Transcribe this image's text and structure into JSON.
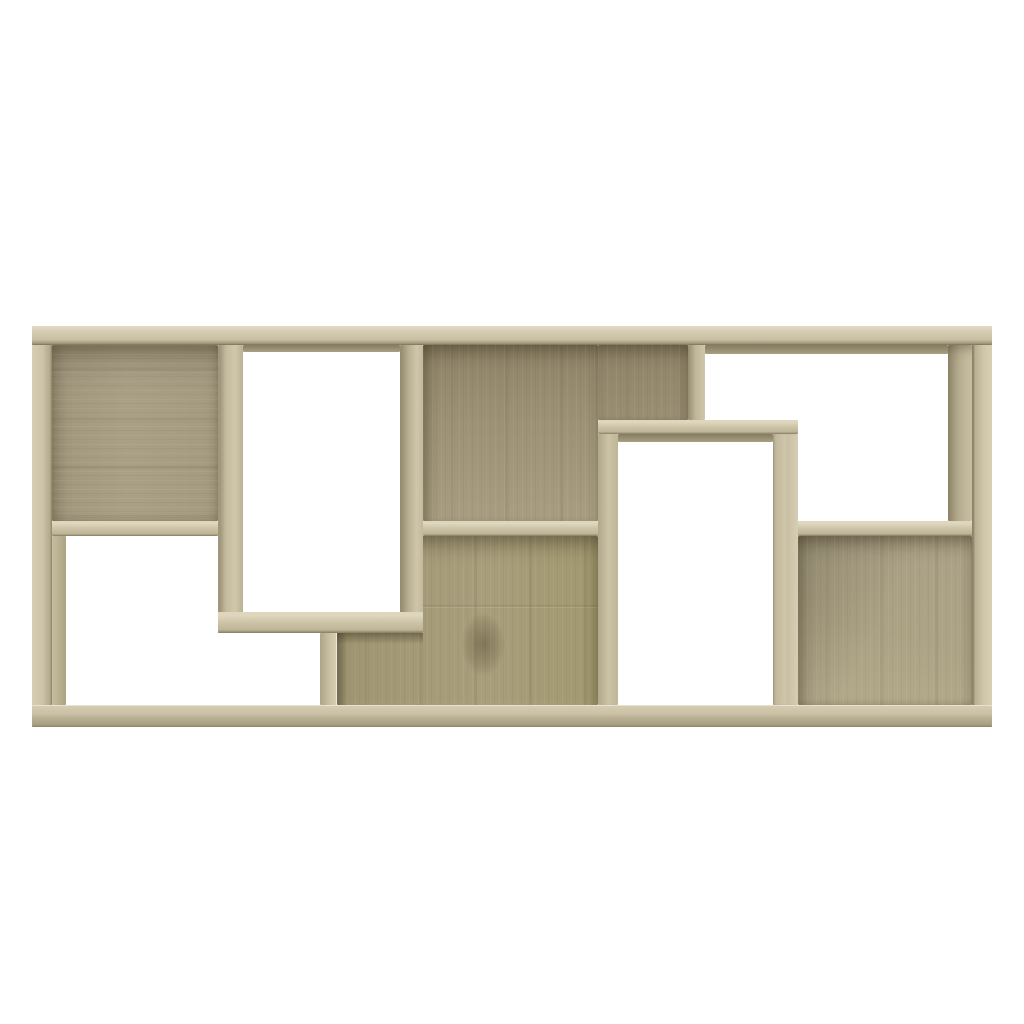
{
  "scene": {
    "background": "#ffffff",
    "object": "geometric-cube-bookcase",
    "finish": "sonoma-oak",
    "compartments_open": 4,
    "compartments_backed": 5,
    "unit_rect": {
      "x": 32,
      "y": 326,
      "w": 960,
      "h": 401
    }
  },
  "palette": {
    "bg": "#ffffff",
    "front_light": "#ddd5bc",
    "front": "#cdc4a8",
    "front_dark": "#a89e82",
    "seam": "#7b725a",
    "back": "#a89e83",
    "back_dark": "#8d8266",
    "back_light": "#b3a98d"
  },
  "parts": [
    {
      "id": "back-panel-top-left",
      "cls": "p-back-tl",
      "grain": "h",
      "x": 20,
      "y": 19,
      "w": 166,
      "h": 176
    },
    {
      "id": "back-panel-center-upper",
      "cls": "p-back-cu",
      "grain": "v",
      "x": 391,
      "y": 19,
      "w": 175,
      "h": 176
    },
    {
      "id": "back-panel-above-box2",
      "cls": "p-back-ab2",
      "grain": "v",
      "x": 566,
      "y": 19,
      "w": 90,
      "h": 75
    },
    {
      "id": "back-panel-center-lower",
      "cls": "p-back-cl",
      "grain": "v",
      "x": 305,
      "y": 210,
      "w": 261,
      "h": 169,
      "clip": "polygon(32.95% 0, 100% 0, 100% 100%, 0 100%, 0 57.4%, 32.95% 57.4%)"
    },
    {
      "id": "shade-under-box1-bottom",
      "cls": "p-shade-b",
      "x": 305,
      "y": 307,
      "w": 86,
      "h": 11
    },
    {
      "id": "shade-right-of-divider",
      "cls": "p-shade-r",
      "x": 305,
      "y": 307,
      "w": 11,
      "h": 72
    },
    {
      "id": "back-panel-bottom-right",
      "cls": "p-back-br",
      "grain": "v",
      "x": 766,
      "y": 210,
      "w": 174,
      "h": 169
    },
    {
      "id": "right-panel-inner-face",
      "cls": "p-strip-rp",
      "x": 916,
      "y": 19,
      "w": 24,
      "h": 176
    },
    {
      "id": "top-panel-underside-right",
      "cls": "p-strip-tu",
      "x": 673,
      "y": 19,
      "w": 243,
      "h": 9
    },
    {
      "id": "top-panel-underside-box1",
      "cls": "p-strip-tu",
      "x": 211,
      "y": 19,
      "w": 157,
      "h": 7
    },
    {
      "id": "box2-top-underside",
      "cls": "p-strip-tu",
      "x": 586,
      "y": 108,
      "w": 155,
      "h": 8
    },
    {
      "id": "left-panel-inner-face",
      "cls": "p-strip-lp",
      "x": 20,
      "y": 210,
      "w": 14,
      "h": 169
    },
    {
      "id": "mid-shelf-left",
      "cls": "p-shelf",
      "x": 20,
      "y": 195,
      "w": 166,
      "h": 15
    },
    {
      "id": "mid-shelf-center",
      "cls": "p-shelf",
      "x": 391,
      "y": 195,
      "w": 175,
      "h": 15
    },
    {
      "id": "mid-shelf-right",
      "cls": "p-shelf",
      "x": 766,
      "y": 195,
      "w": 174,
      "h": 15
    },
    {
      "id": "divider-top-right",
      "cls": "p-divt",
      "x": 656,
      "y": 19,
      "w": 17,
      "h": 75
    },
    {
      "id": "divider-bottom-left",
      "cls": "p-divb",
      "x": 288,
      "y": 307,
      "w": 17,
      "h": 72
    },
    {
      "id": "box1-left-wall",
      "cls": "p-b1l",
      "x": 186,
      "y": 19,
      "w": 25,
      "h": 288
    },
    {
      "id": "box1-right-wall",
      "cls": "p-b1r",
      "x": 368,
      "y": 19,
      "w": 23,
      "h": 288
    },
    {
      "id": "box1-bottom-panel",
      "cls": "p-shelf",
      "x": 186,
      "y": 286,
      "w": 205,
      "h": 21
    },
    {
      "id": "box2-top-panel",
      "cls": "p-shelf",
      "x": 566,
      "y": 94,
      "w": 200,
      "h": 14
    },
    {
      "id": "box2-left-wall",
      "cls": "p-b2l",
      "x": 566,
      "y": 108,
      "w": 20,
      "h": 271
    },
    {
      "id": "box2-right-wall",
      "cls": "p-b2r",
      "x": 741,
      "y": 108,
      "w": 25,
      "h": 271
    },
    {
      "id": "left-side-panel",
      "cls": "p-left",
      "x": 0,
      "y": 0,
      "w": 20,
      "h": 401
    },
    {
      "id": "right-side-panel",
      "cls": "p-right",
      "x": 940,
      "y": 0,
      "w": 20,
      "h": 401
    },
    {
      "id": "top-panel",
      "cls": "p-top",
      "x": 0,
      "y": 0,
      "w": 960,
      "h": 19
    },
    {
      "id": "bottom-panel",
      "cls": "p-bottom",
      "x": 0,
      "y": 379,
      "w": 960,
      "h": 22
    }
  ]
}
